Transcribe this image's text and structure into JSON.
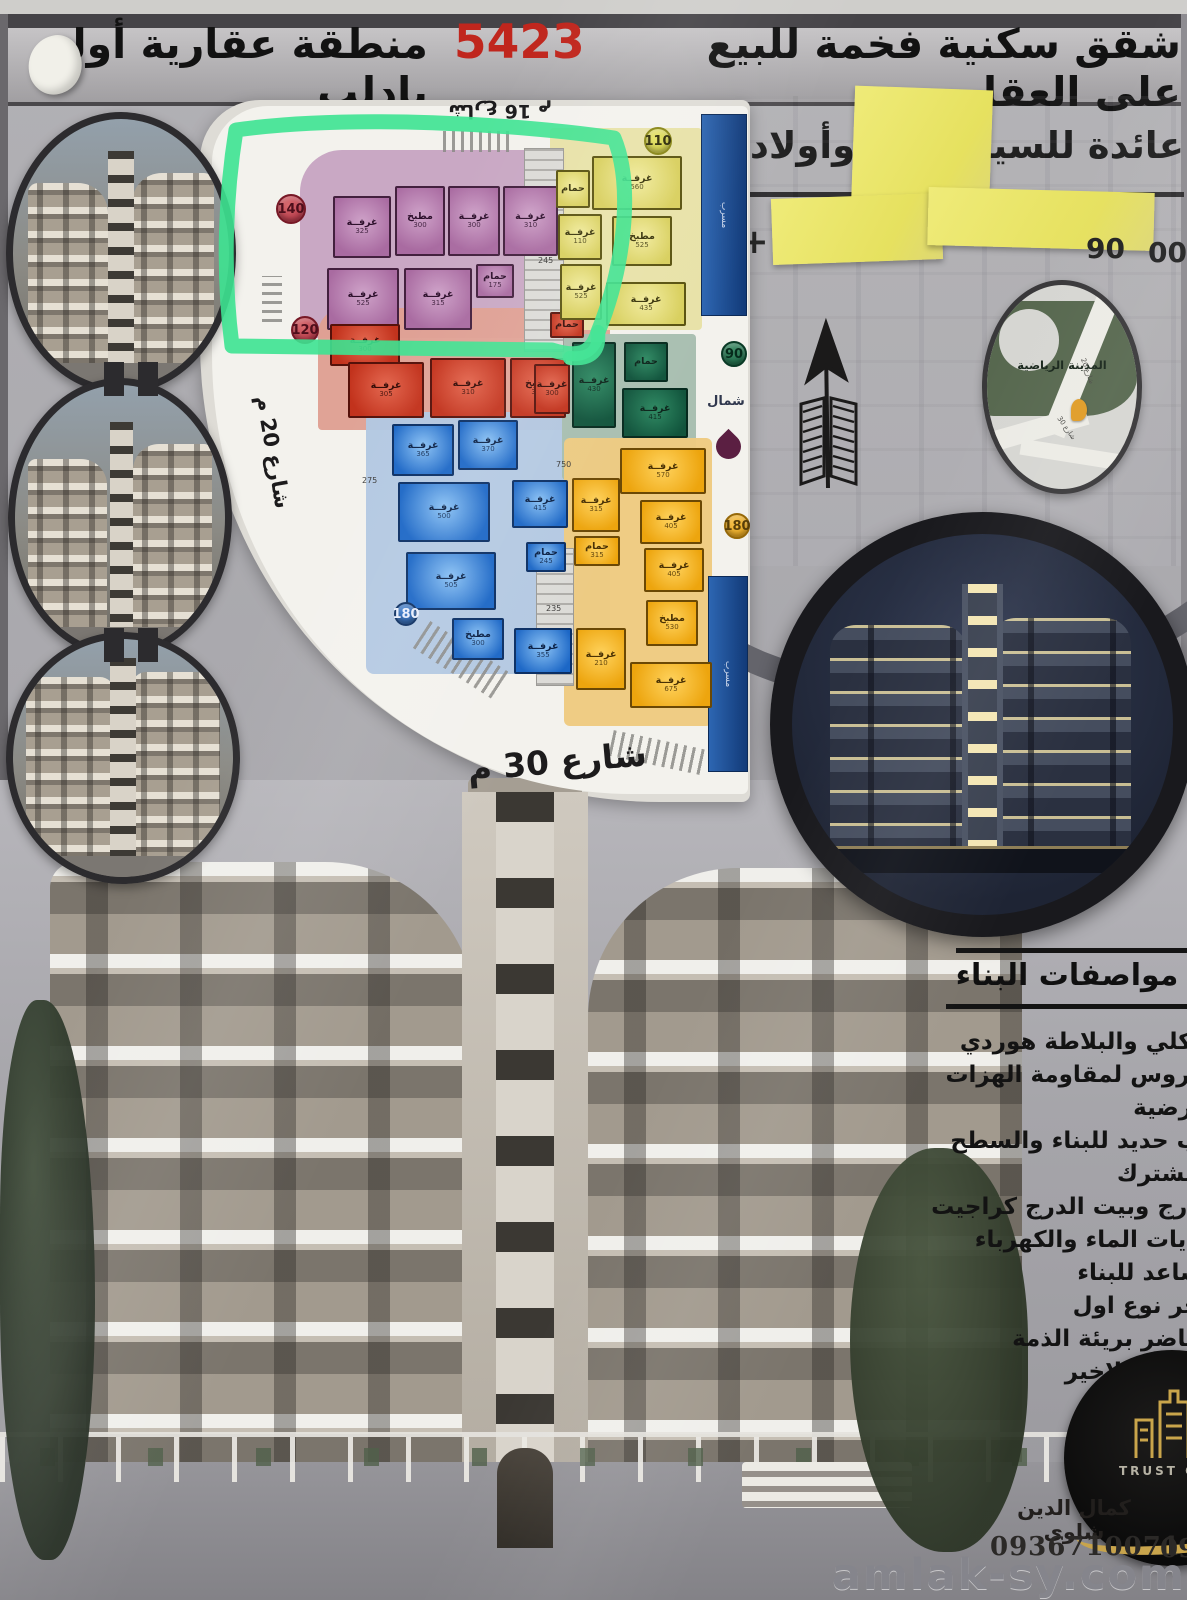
{
  "header": {
    "line1_pre": "شقق سكنية فخمة للبيع على العقار",
    "line1_number": "5423",
    "line1_post": "منطقة عقارية أولى بادلب",
    "owner_right": "عائدة للسيد ع",
    "owner_left": "وأولاده",
    "phone_fragments": {
      "plus": "+",
      "mid": "90",
      "right": "009"
    }
  },
  "plan": {
    "streets": {
      "top": "شارع 16 م",
      "left": "شارع 20 م",
      "bottom": "شارع 30 م"
    },
    "north_label": "شمال",
    "duct_label": "مسرب",
    "badges": {
      "pink": "140",
      "red": "120",
      "yellow_light": "110",
      "green": "90",
      "amber": "180",
      "blue": "180"
    },
    "rooms": {
      "pink": [
        {
          "label": "غرفــة",
          "dim": "325"
        },
        {
          "label": "مطبخ",
          "dim": "300"
        },
        {
          "label": "غرفــة",
          "dim": "300"
        },
        {
          "label": "غرفــة",
          "dim": "310"
        },
        {
          "label": "غرفــة",
          "dim": "525"
        },
        {
          "label": "غرفــة",
          "dim": "315"
        },
        {
          "label": "حمام",
          "dim": "175"
        }
      ],
      "red": [
        {
          "label": "غرفــة",
          "dim": "300"
        },
        {
          "label": "غرفــة",
          "dim": "305"
        },
        {
          "label": "غرفــة",
          "dim": "310"
        },
        {
          "label": "مطبخ",
          "dim": "310"
        },
        {
          "label": "غرفــة",
          "dim": "300"
        },
        {
          "label": "حمام",
          "dim": ""
        }
      ],
      "blue": [
        {
          "label": "غرفــة",
          "dim": "365"
        },
        {
          "label": "غرفــة",
          "dim": "370"
        },
        {
          "label": "غرفــة",
          "dim": "500"
        },
        {
          "label": "غرفــة",
          "dim": "505"
        },
        {
          "label": "مطبخ",
          "dim": "300"
        },
        {
          "label": "غرفــة",
          "dim": "355"
        },
        {
          "label": "غرفــة",
          "dim": "415"
        },
        {
          "label": "حمام",
          "dim": "245"
        }
      ],
      "yellow_light": [
        {
          "label": "غرفــة",
          "dim": "560"
        },
        {
          "label": "مطبخ",
          "dim": "525"
        },
        {
          "label": "غرفــة",
          "dim": "435"
        },
        {
          "label": "غرفــة",
          "dim": "110"
        },
        {
          "label": "غرفــة",
          "dim": "525"
        },
        {
          "label": "حمام",
          "dim": ""
        }
      ],
      "green": [
        {
          "label": "غرفــة",
          "dim": "430"
        },
        {
          "label": "غرفــة",
          "dim": "415"
        },
        {
          "label": "حمام",
          "dim": ""
        }
      ],
      "amber": [
        {
          "label": "غرفــة",
          "dim": "570"
        },
        {
          "label": "غرفــة",
          "dim": "405"
        },
        {
          "label": "غرفــة",
          "dim": "405"
        },
        {
          "label": "مطبخ",
          "dim": "530"
        },
        {
          "label": "غرفــة",
          "dim": "675"
        },
        {
          "label": "غرفــة",
          "dim": "315"
        },
        {
          "label": "حمام",
          "dim": "315"
        },
        {
          "label": "غرفــة",
          "dim": "210"
        }
      ]
    },
    "dim_notes": [
      "245",
      "750",
      "235",
      "275"
    ]
  },
  "map_circle": {
    "area_label": "المدينة الرياضية",
    "street_a": "شارع 20",
    "street_b": "شارع 30"
  },
  "specs": {
    "title": "مواصفات البناء",
    "items": [
      "هيكلي والبلاطة هوردي",
      "مدروس لمقاومة الهزات الارضية",
      "باب حديد للبناء والسطح المشترك",
      "الدرج وبيت الدرج كراجيت",
      "امايات الماء والكهرباء",
      "مصاعد للبناء",
      "حجر نوع اول",
      "محاضر بريئة الذمة",
      "السطح الاخير"
    ]
  },
  "contact": {
    "company_fragment": "TRUST COM",
    "name": "كمال الدين شاوي",
    "phone": "0936710071",
    "phone2_fragment": "09",
    "watermark": "amlak-sy.com"
  }
}
